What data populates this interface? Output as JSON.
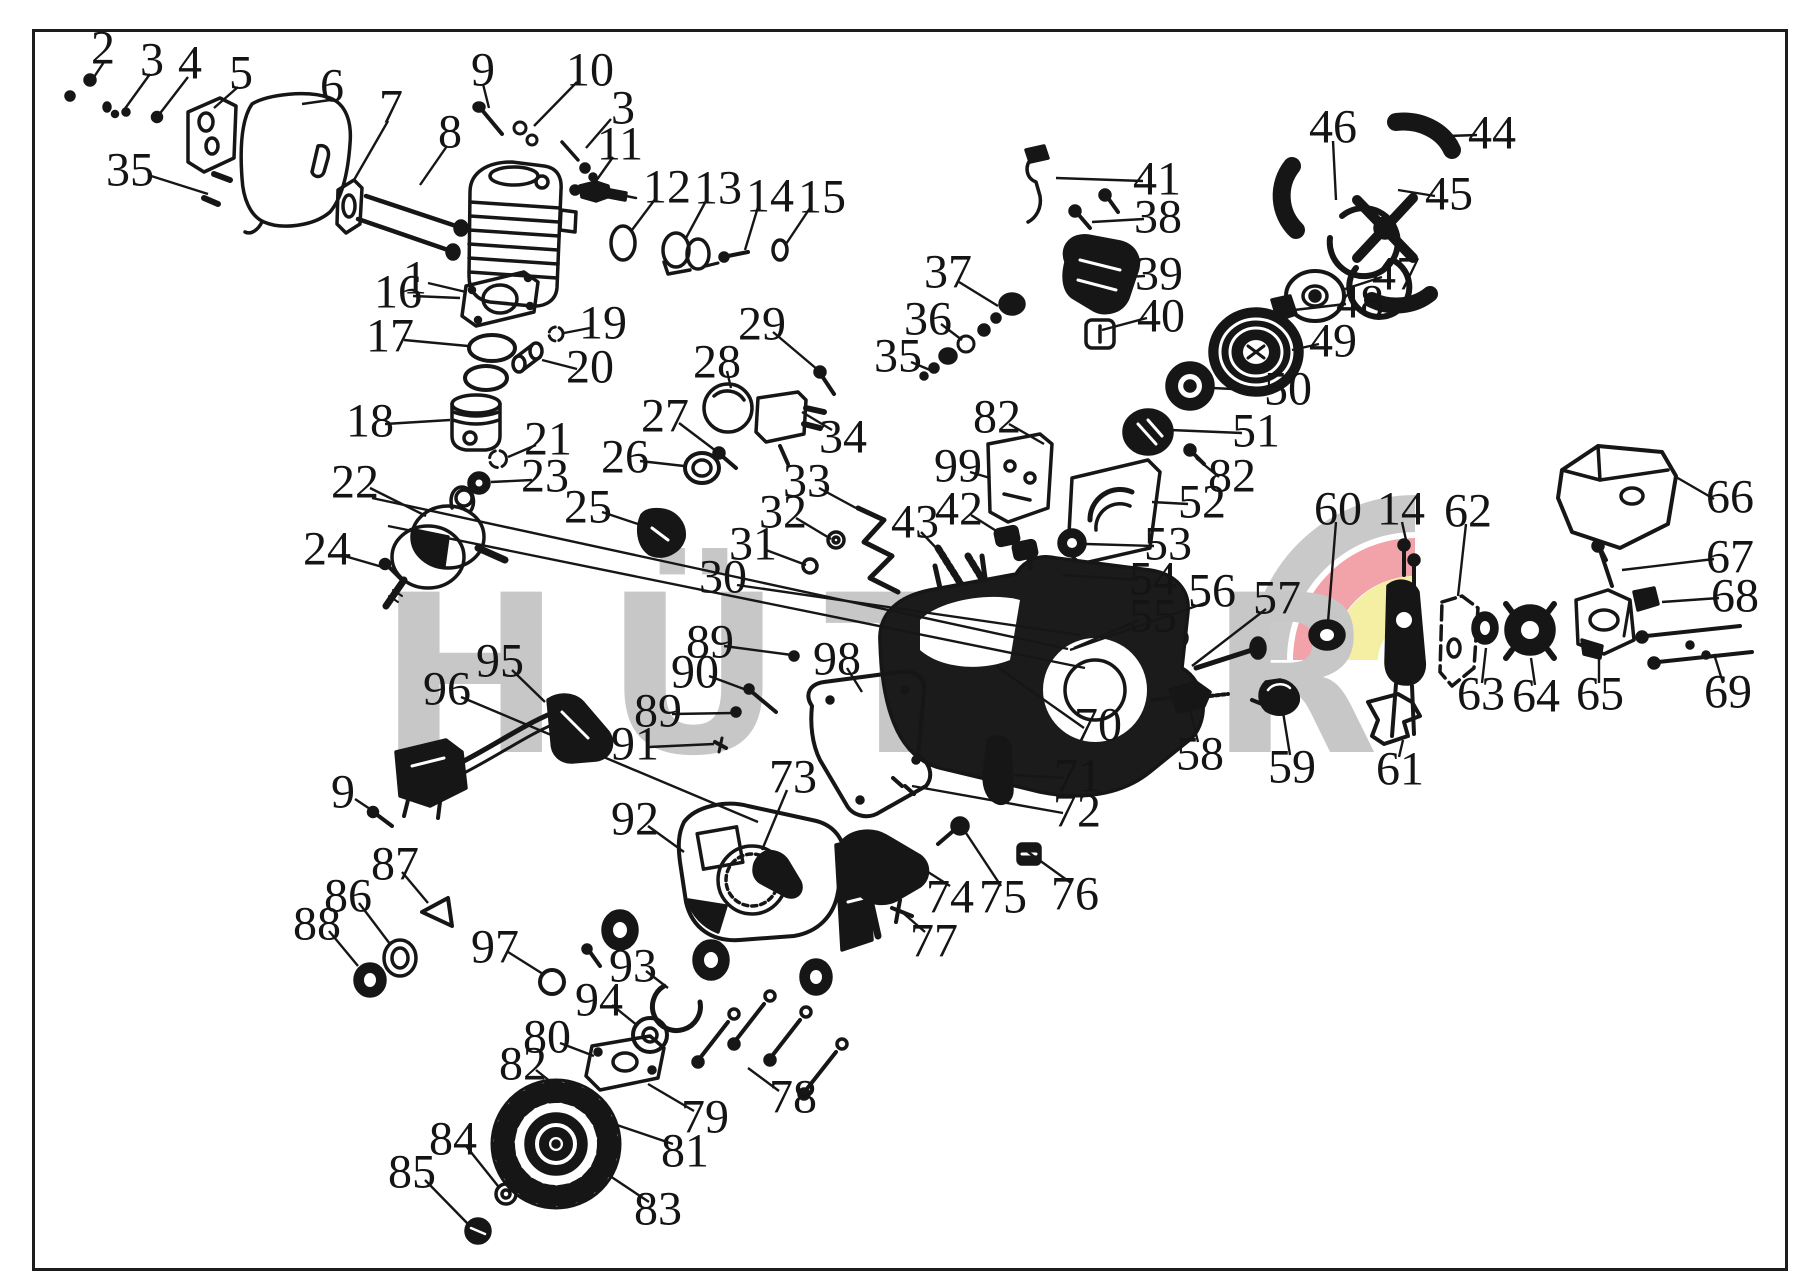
{
  "watermark": {
    "text": "HÜTER",
    "color": "#c7c7c7"
  },
  "emblem": {
    "gray": "#c9c9c9",
    "red": "#f2a3a9",
    "yellow": "#f4efa3"
  },
  "frame_color": "#1c1c1c",
  "ink": "#161616",
  "callouts": [
    {
      "n": "2",
      "x": 103,
      "y": 48,
      "line": [
        104,
        62,
        92,
        80
      ]
    },
    {
      "n": "3",
      "x": 152,
      "y": 60,
      "line": [
        150,
        74,
        124,
        110
      ]
    },
    {
      "n": "4",
      "x": 190,
      "y": 63,
      "line": [
        188,
        77,
        158,
        116
      ]
    },
    {
      "n": "5",
      "x": 241,
      "y": 73,
      "line": [
        238,
        87,
        214,
        108
      ]
    },
    {
      "n": "6",
      "x": 332,
      "y": 86,
      "line": [
        330,
        100,
        302,
        104
      ]
    },
    {
      "n": "7",
      "x": 391,
      "y": 107,
      "line": [
        388,
        121,
        354,
        180
      ]
    },
    {
      "n": "8",
      "x": 450,
      "y": 132,
      "line": [
        447,
        146,
        420,
        185
      ]
    },
    {
      "n": "9",
      "x": 483,
      "y": 70,
      "line": [
        483,
        84,
        489,
        108
      ]
    },
    {
      "n": "10",
      "x": 590,
      "y": 70,
      "line": [
        577,
        82,
        534,
        126
      ]
    },
    {
      "n": "3",
      "x": 623,
      "y": 108,
      "line": [
        611,
        119,
        586,
        148
      ]
    },
    {
      "n": "11",
      "x": 620,
      "y": 144,
      "line": [
        613,
        157,
        596,
        181
      ]
    },
    {
      "n": "12",
      "x": 667,
      "y": 187,
      "line": [
        656,
        198,
        632,
        230
      ]
    },
    {
      "n": "13",
      "x": 718,
      "y": 188,
      "line": [
        707,
        199,
        686,
        238
      ]
    },
    {
      "n": "14",
      "x": 770,
      "y": 196,
      "line": [
        758,
        207,
        745,
        250
      ]
    },
    {
      "n": "15",
      "x": 822,
      "y": 197,
      "line": [
        810,
        208,
        786,
        244
      ]
    },
    {
      "n": "1",
      "x": 415,
      "y": 278,
      "line": [
        428,
        283,
        466,
        292
      ]
    },
    {
      "n": "16",
      "x": 398,
      "y": 292,
      "line": [
        413,
        296,
        460,
        298
      ]
    },
    {
      "n": "17",
      "x": 390,
      "y": 336,
      "line": [
        404,
        340,
        468,
        346
      ]
    },
    {
      "n": "18",
      "x": 370,
      "y": 421,
      "line": [
        385,
        424,
        450,
        420
      ]
    },
    {
      "n": "19",
      "x": 603,
      "y": 323,
      "line": [
        590,
        328,
        564,
        333
      ]
    },
    {
      "n": "20",
      "x": 590,
      "y": 367,
      "line": [
        577,
        369,
        542,
        360
      ]
    },
    {
      "n": "21",
      "x": 548,
      "y": 439,
      "line": [
        536,
        445,
        508,
        457
      ]
    },
    {
      "n": "23",
      "x": 545,
      "y": 476,
      "line": [
        532,
        480,
        491,
        482
      ]
    },
    {
      "n": "22",
      "x": 355,
      "y": 482,
      "line": [
        370,
        488,
        426,
        516
      ]
    },
    {
      "n": "24",
      "x": 327,
      "y": 549,
      "line": [
        341,
        555,
        386,
        568
      ]
    },
    {
      "n": "25",
      "x": 588,
      "y": 507,
      "line": [
        602,
        512,
        638,
        524
      ]
    },
    {
      "n": "26",
      "x": 625,
      "y": 457,
      "line": [
        640,
        461,
        684,
        466
      ]
    },
    {
      "n": "27",
      "x": 665,
      "y": 416,
      "line": [
        679,
        423,
        716,
        451
      ]
    },
    {
      "n": "28",
      "x": 717,
      "y": 362,
      "line": [
        727,
        371,
        731,
        388
      ]
    },
    {
      "n": "29",
      "x": 762,
      "y": 324,
      "line": [
        773,
        332,
        818,
        370
      ]
    },
    {
      "n": "30",
      "x": 723,
      "y": 577,
      "line": [
        737,
        585,
        1080,
        635
      ]
    },
    {
      "n": "31",
      "x": 753,
      "y": 544,
      "line": [
        766,
        550,
        806,
        565
      ]
    },
    {
      "n": "32",
      "x": 783,
      "y": 512,
      "line": [
        796,
        518,
        831,
        539
      ]
    },
    {
      "n": "33",
      "x": 807,
      "y": 481,
      "line": [
        819,
        488,
        856,
        508
      ]
    },
    {
      "n": "34",
      "x": 843,
      "y": 437,
      "line": [
        832,
        430,
        802,
        412
      ]
    },
    {
      "n": "35",
      "x": 130,
      "y": 170,
      "line": [
        148,
        175,
        208,
        194
      ]
    },
    {
      "n": "36",
      "x": 928,
      "y": 319,
      "line": [
        941,
        324,
        962,
        340
      ]
    },
    {
      "n": "37",
      "x": 948,
      "y": 272,
      "line": [
        959,
        282,
        998,
        306
      ]
    },
    {
      "n": "35",
      "x": 898,
      "y": 356,
      "line": [
        911,
        362,
        930,
        370
      ]
    },
    {
      "n": "38",
      "x": 1158,
      "y": 217,
      "line": [
        1144,
        219,
        1092,
        222
      ]
    },
    {
      "n": "39",
      "x": 1159,
      "y": 274,
      "line": [
        1145,
        276,
        1106,
        278
      ]
    },
    {
      "n": "40",
      "x": 1161,
      "y": 316,
      "line": [
        1147,
        318,
        1102,
        330
      ]
    },
    {
      "n": "41",
      "x": 1157,
      "y": 179,
      "line": [
        1143,
        181,
        1056,
        178
      ]
    },
    {
      "n": "42",
      "x": 959,
      "y": 509,
      "line": [
        971,
        515,
        998,
        532
      ]
    },
    {
      "n": "43",
      "x": 915,
      "y": 522,
      "line": [
        921,
        532,
        940,
        552
      ]
    },
    {
      "n": "44",
      "x": 1492,
      "y": 133,
      "line": [
        1477,
        135,
        1448,
        136
      ]
    },
    {
      "n": "45",
      "x": 1449,
      "y": 194,
      "line": [
        1435,
        196,
        1398,
        190
      ]
    },
    {
      "n": "46",
      "x": 1333,
      "y": 127,
      "line": [
        1333,
        141,
        1336,
        200
      ]
    },
    {
      "n": "47",
      "x": 1396,
      "y": 274,
      "line": [
        1382,
        277,
        1342,
        290
      ]
    },
    {
      "n": "48",
      "x": 1360,
      "y": 302,
      "line": [
        1346,
        304,
        1294,
        310
      ]
    },
    {
      "n": "49",
      "x": 1333,
      "y": 341,
      "line": [
        1319,
        344,
        1292,
        350
      ]
    },
    {
      "n": "50",
      "x": 1288,
      "y": 389,
      "line": [
        1274,
        391,
        1212,
        388
      ]
    },
    {
      "n": "51",
      "x": 1256,
      "y": 431,
      "line": [
        1242,
        433,
        1170,
        430
      ]
    },
    {
      "n": "82",
      "x": 1232,
      "y": 476,
      "line": [
        1219,
        477,
        1196,
        458
      ]
    },
    {
      "n": "52",
      "x": 1202,
      "y": 502,
      "line": [
        1188,
        504,
        1152,
        502
      ]
    },
    {
      "n": "53",
      "x": 1168,
      "y": 544,
      "line": [
        1154,
        546,
        1086,
        544
      ]
    },
    {
      "n": "54",
      "x": 1153,
      "y": 579,
      "line": [
        1139,
        580,
        1063,
        575
      ]
    },
    {
      "n": "55",
      "x": 1153,
      "y": 616,
      "line": [
        1139,
        620,
        1074,
        648
      ]
    },
    {
      "n": "56",
      "x": 1212,
      "y": 591,
      "line": [
        1205,
        603,
        1070,
        650
      ]
    },
    {
      "n": "57",
      "x": 1277,
      "y": 598,
      "line": [
        1266,
        609,
        1192,
        666
      ]
    },
    {
      "n": "60",
      "x": 1338,
      "y": 509,
      "line": [
        1336,
        522,
        1328,
        622
      ]
    },
    {
      "n": "14",
      "x": 1401,
      "y": 509,
      "line": [
        1402,
        522,
        1406,
        540
      ]
    },
    {
      "n": "62",
      "x": 1468,
      "y": 511,
      "line": [
        1466,
        524,
        1458,
        596
      ]
    },
    {
      "n": "66",
      "x": 1730,
      "y": 497,
      "line": [
        1714,
        499,
        1676,
        477
      ]
    },
    {
      "n": "67",
      "x": 1730,
      "y": 557,
      "line": [
        1714,
        559,
        1622,
        570
      ]
    },
    {
      "n": "68",
      "x": 1735,
      "y": 596,
      "line": [
        1719,
        598,
        1662,
        602
      ]
    },
    {
      "n": "69",
      "x": 1728,
      "y": 692,
      "line": [
        1723,
        683,
        1714,
        654
      ]
    },
    {
      "n": "63",
      "x": 1481,
      "y": 694,
      "line": [
        1482,
        683,
        1486,
        648
      ]
    },
    {
      "n": "64",
      "x": 1536,
      "y": 696,
      "line": [
        1535,
        685,
        1531,
        658
      ]
    },
    {
      "n": "65",
      "x": 1600,
      "y": 694,
      "line": [
        1599,
        683,
        1599,
        652
      ]
    },
    {
      "n": "61",
      "x": 1400,
      "y": 769,
      "line": [
        1399,
        757,
        1403,
        740
      ]
    },
    {
      "n": "58",
      "x": 1200,
      "y": 754,
      "line": [
        1198,
        742,
        1190,
        710
      ]
    },
    {
      "n": "59",
      "x": 1292,
      "y": 767,
      "line": [
        1290,
        755,
        1283,
        712
      ]
    },
    {
      "n": "70",
      "x": 1098,
      "y": 725,
      "line": [
        1084,
        728,
        996,
        666
      ]
    },
    {
      "n": "71",
      "x": 1078,
      "y": 776,
      "line": [
        1064,
        778,
        1014,
        775
      ]
    },
    {
      "n": "72",
      "x": 1077,
      "y": 811,
      "line": [
        1063,
        813,
        912,
        786
      ]
    },
    {
      "n": "73",
      "x": 793,
      "y": 777,
      "line": [
        787,
        790,
        762,
        850
      ]
    },
    {
      "n": "74",
      "x": 950,
      "y": 897,
      "line": [
        950,
        886,
        906,
        858
      ]
    },
    {
      "n": "75",
      "x": 1003,
      "y": 897,
      "line": [
        1001,
        886,
        966,
        833
      ]
    },
    {
      "n": "76",
      "x": 1075,
      "y": 894,
      "line": [
        1071,
        883,
        1028,
        852
      ]
    },
    {
      "n": "77",
      "x": 934,
      "y": 941,
      "line": [
        925,
        932,
        902,
        912
      ]
    },
    {
      "n": "89",
      "x": 710,
      "y": 642,
      "line": [
        724,
        646,
        792,
        655
      ]
    },
    {
      "n": "90",
      "x": 695,
      "y": 672,
      "line": [
        709,
        676,
        752,
        692
      ]
    },
    {
      "n": "89",
      "x": 658,
      "y": 711,
      "line": [
        672,
        714,
        734,
        713
      ]
    },
    {
      "n": "91",
      "x": 635,
      "y": 744,
      "line": [
        649,
        747,
        714,
        744
      ]
    },
    {
      "n": "98",
      "x": 837,
      "y": 659,
      "line": [
        847,
        668,
        862,
        692
      ]
    },
    {
      "n": "95",
      "x": 500,
      "y": 661,
      "line": [
        512,
        670,
        545,
        702
      ]
    },
    {
      "n": "96",
      "x": 447,
      "y": 689,
      "line": [
        461,
        697,
        758,
        822
      ]
    },
    {
      "n": "9",
      "x": 343,
      "y": 792,
      "line": [
        355,
        799,
        376,
        813
      ]
    },
    {
      "n": "87",
      "x": 395,
      "y": 864,
      "line": [
        402,
        872,
        428,
        903
      ]
    },
    {
      "n": "86",
      "x": 348,
      "y": 896,
      "line": [
        359,
        903,
        390,
        944
      ]
    },
    {
      "n": "88",
      "x": 317,
      "y": 924,
      "line": [
        329,
        931,
        358,
        966
      ]
    },
    {
      "n": "92",
      "x": 635,
      "y": 819,
      "line": [
        648,
        826,
        684,
        852
      ]
    },
    {
      "n": "97",
      "x": 495,
      "y": 947,
      "line": [
        508,
        952,
        543,
        974
      ]
    },
    {
      "n": "93",
      "x": 633,
      "y": 966,
      "line": [
        646,
        971,
        668,
        988
      ]
    },
    {
      "n": "94",
      "x": 599,
      "y": 1000,
      "line": [
        612,
        1005,
        638,
        1026
      ]
    },
    {
      "n": "80",
      "x": 547,
      "y": 1037,
      "line": [
        560,
        1043,
        594,
        1056
      ]
    },
    {
      "n": "82",
      "x": 523,
      "y": 1064,
      "line": [
        536,
        1070,
        556,
        1086
      ]
    },
    {
      "n": "84",
      "x": 453,
      "y": 1139,
      "line": [
        466,
        1146,
        498,
        1186
      ]
    },
    {
      "n": "85",
      "x": 412,
      "y": 1172,
      "line": [
        425,
        1180,
        468,
        1224
      ]
    },
    {
      "n": "83",
      "x": 658,
      "y": 1209,
      "line": [
        649,
        1202,
        604,
        1172
      ]
    },
    {
      "n": "79",
      "x": 705,
      "y": 1117,
      "line": [
        694,
        1111,
        648,
        1084
      ]
    },
    {
      "n": "81",
      "x": 685,
      "y": 1151,
      "line": [
        673,
        1144,
        614,
        1124
      ]
    },
    {
      "n": "78",
      "x": 793,
      "y": 1097,
      "line": [
        779,
        1091,
        748,
        1068
      ]
    },
    {
      "n": "82",
      "x": 997,
      "y": 417,
      "line": [
        1009,
        424,
        1044,
        444
      ]
    },
    {
      "n": "99",
      "x": 958,
      "y": 466,
      "line": [
        970,
        472,
        990,
        478
      ]
    }
  ],
  "extra_lines": [
    [
      372,
      498,
      1068,
      649
    ],
    [
      388,
      526,
      1085,
      668
    ]
  ]
}
